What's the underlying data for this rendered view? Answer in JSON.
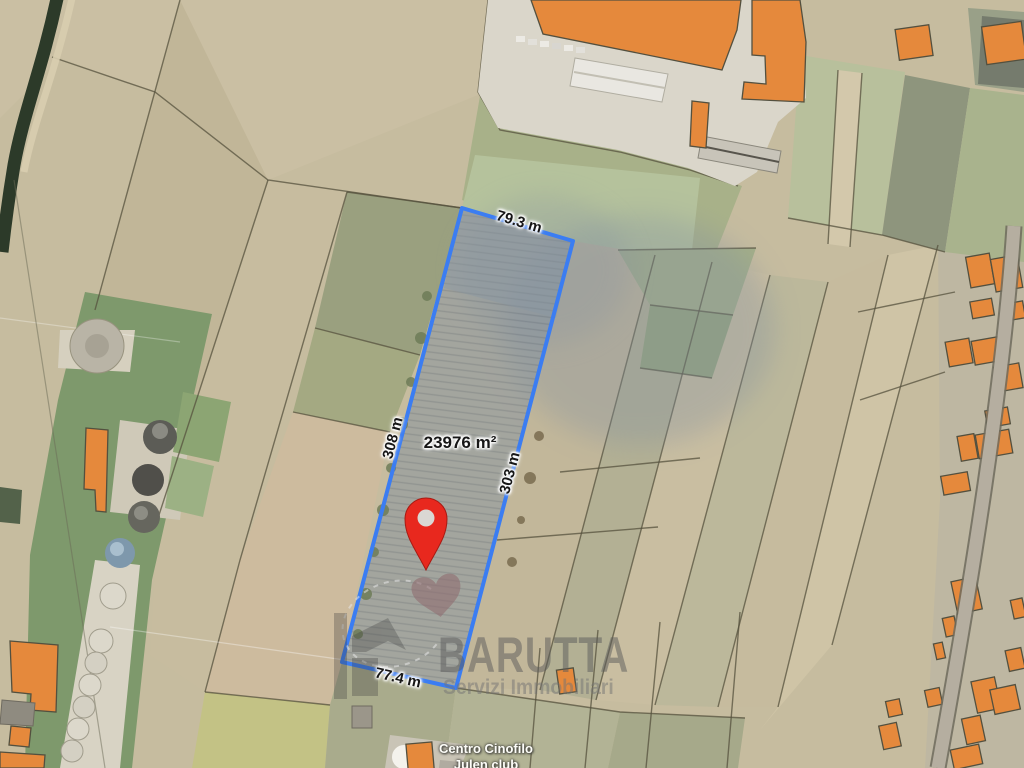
{
  "map": {
    "description": "Satellite cadastral map with highlighted land parcel for sale",
    "parcel": {
      "area_label": "23976 m²",
      "measurements": {
        "top": "79.3 m",
        "left": "308 m",
        "right": "303 m",
        "bottom": "77.4 m"
      },
      "outline_color": "#3b7df2"
    },
    "marker": {
      "color": "#e8281e"
    },
    "poi": {
      "line1": "Centro Cinofilo",
      "line2": "Julen club"
    },
    "watermark": {
      "brand": "BARUTTA",
      "tagline": "Servizi Immobiliari"
    },
    "colors": {
      "building": "#e5893c",
      "canal": "#2c3a29"
    }
  }
}
